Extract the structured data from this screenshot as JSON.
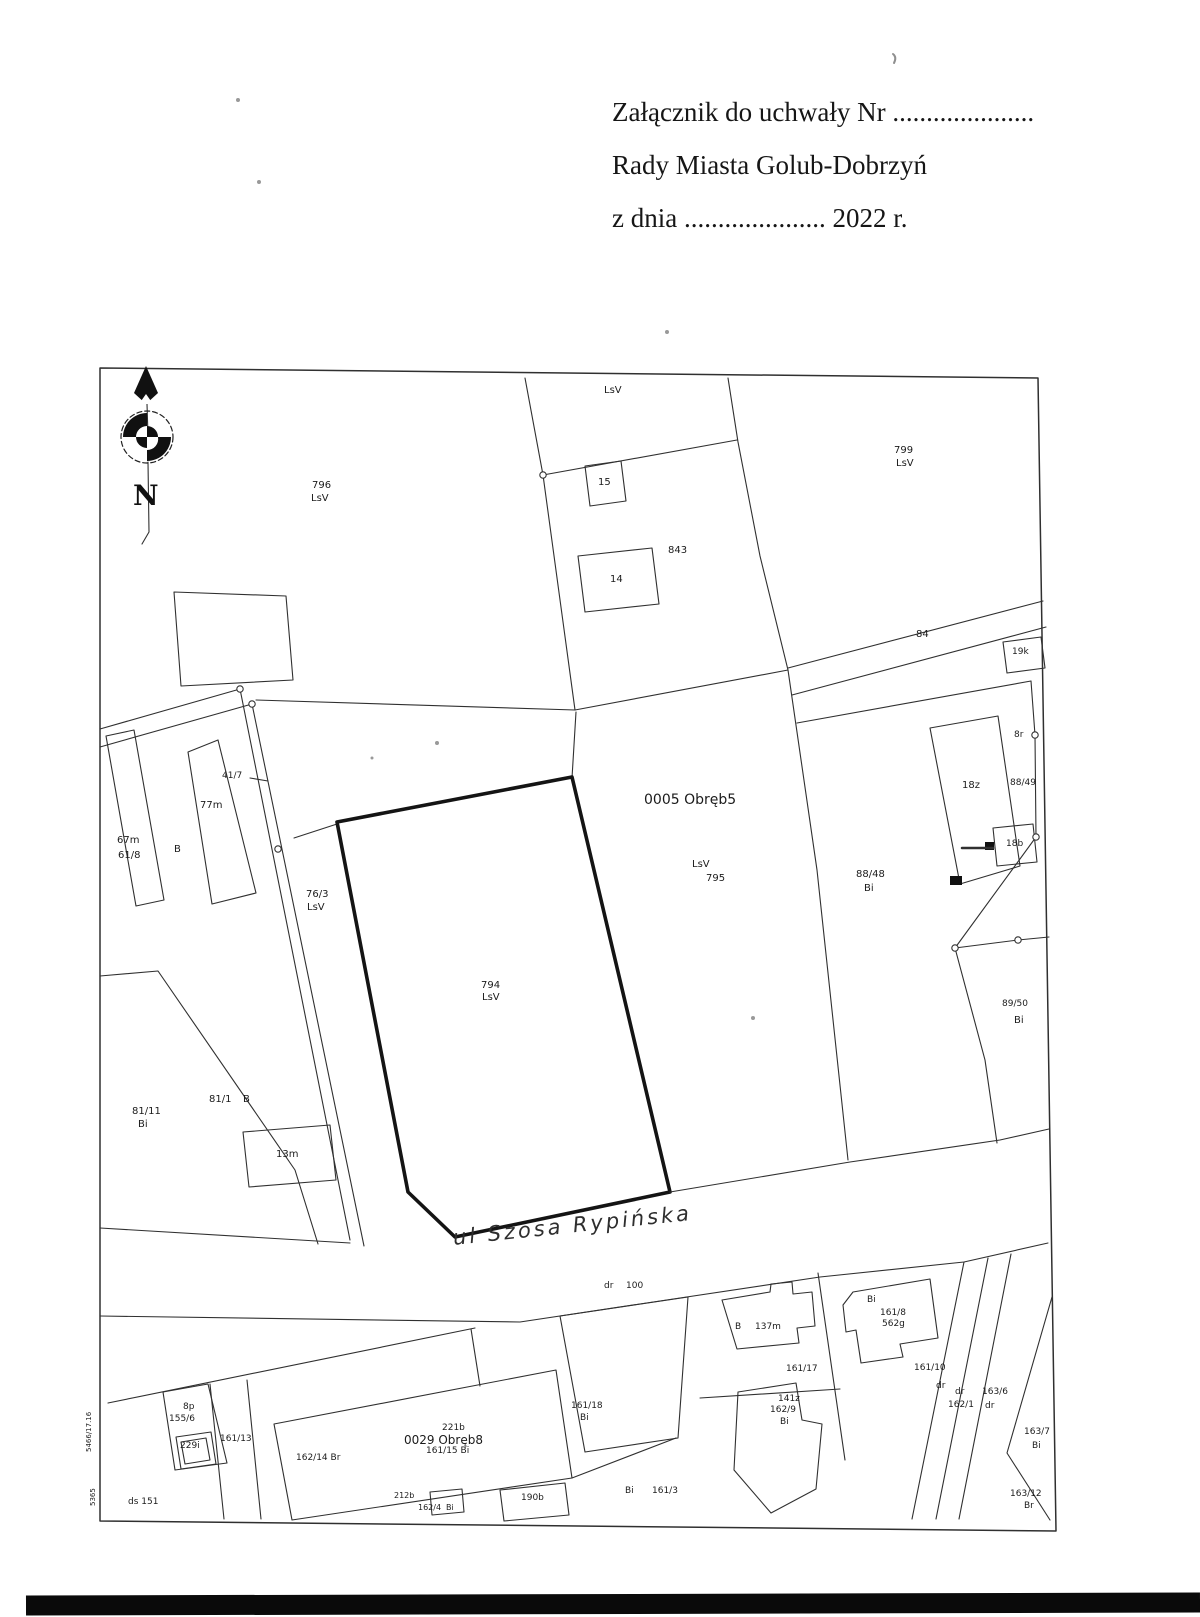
{
  "document": {
    "attachment_line": "Załącznik do uchwały Nr .....................",
    "council_line": "Rady Miasta Golub-Dobrzyń",
    "date_line": "z dnia ..................... 2022 r."
  },
  "map": {
    "compass_n": "N",
    "ink_color": "#303030",
    "bold_parcel_color": "#141414",
    "labels": [
      {
        "text": "796",
        "x": 312,
        "y": 481
      },
      {
        "text": "LsV",
        "x": 311,
        "y": 494
      },
      {
        "text": "LsV",
        "x": 604,
        "y": 386
      },
      {
        "text": "15",
        "x": 598,
        "y": 478
      },
      {
        "text": "14",
        "x": 610,
        "y": 575
      },
      {
        "text": "843",
        "x": 668,
        "y": 546
      },
      {
        "text": "799",
        "x": 894,
        "y": 446
      },
      {
        "text": "LsV",
        "x": 896,
        "y": 459
      },
      {
        "text": "84",
        "x": 916,
        "y": 630
      },
      {
        "text": "19k",
        "x": 1012,
        "y": 648,
        "size": 9
      },
      {
        "text": "8r",
        "x": 1014,
        "y": 731,
        "size": 9
      },
      {
        "text": "88/49",
        "x": 1010,
        "y": 779,
        "size": 9
      },
      {
        "text": "18z",
        "x": 962,
        "y": 781
      },
      {
        "text": "18b",
        "x": 1006,
        "y": 840,
        "size": 9
      },
      {
        "text": "88/48",
        "x": 856,
        "y": 870
      },
      {
        "text": "Bi",
        "x": 864,
        "y": 884
      },
      {
        "text": "0005 Obręb5",
        "x": 644,
        "y": 793,
        "size": 14
      },
      {
        "text": "LsV",
        "x": 692,
        "y": 860
      },
      {
        "text": "795",
        "x": 706,
        "y": 874
      },
      {
        "text": "41/7",
        "x": 222,
        "y": 772,
        "size": 9
      },
      {
        "text": "77m",
        "x": 200,
        "y": 801
      },
      {
        "text": "67m",
        "x": 117,
        "y": 836
      },
      {
        "text": "61/8",
        "x": 118,
        "y": 851
      },
      {
        "text": "B",
        "x": 174,
        "y": 845
      },
      {
        "text": "76/3",
        "x": 306,
        "y": 890
      },
      {
        "text": "LsV",
        "x": 307,
        "y": 903
      },
      {
        "text": "794",
        "x": 481,
        "y": 981
      },
      {
        "text": "LsV",
        "x": 482,
        "y": 993
      },
      {
        "text": "89/50",
        "x": 1002,
        "y": 1000,
        "size": 9
      },
      {
        "text": "Bi",
        "x": 1014,
        "y": 1016
      },
      {
        "text": "81/11",
        "x": 132,
        "y": 1107
      },
      {
        "text": "Bi",
        "x": 138,
        "y": 1120
      },
      {
        "text": "81/1",
        "x": 209,
        "y": 1095
      },
      {
        "text": "B",
        "x": 243,
        "y": 1095
      },
      {
        "text": "13m",
        "x": 276,
        "y": 1150
      },
      {
        "text": "ul Szosa Rypińska",
        "x": 452,
        "y": 1228,
        "size": 21,
        "rot": -6,
        "hand": true
      },
      {
        "text": "dr",
        "x": 604,
        "y": 1282,
        "size": 9
      },
      {
        "text": "100",
        "x": 626,
        "y": 1282,
        "size": 9
      },
      {
        "text": "B",
        "x": 735,
        "y": 1323,
        "size": 9
      },
      {
        "text": "137m",
        "x": 755,
        "y": 1323,
        "size": 9
      },
      {
        "text": "Bi",
        "x": 867,
        "y": 1296,
        "size": 9
      },
      {
        "text": "161/8",
        "x": 880,
        "y": 1309,
        "size": 9
      },
      {
        "text": "562g",
        "x": 882,
        "y": 1320,
        "size": 9
      },
      {
        "text": "161/17",
        "x": 786,
        "y": 1365,
        "size": 9
      },
      {
        "text": "141z",
        "x": 778,
        "y": 1395,
        "size": 9
      },
      {
        "text": "162/9",
        "x": 770,
        "y": 1406,
        "size": 9
      },
      {
        "text": "Bi",
        "x": 780,
        "y": 1418,
        "size": 9
      },
      {
        "text": "161/10",
        "x": 914,
        "y": 1364,
        "size": 9
      },
      {
        "text": "dr",
        "x": 936,
        "y": 1382,
        "size": 9
      },
      {
        "text": "dr",
        "x": 955,
        "y": 1388,
        "size": 9
      },
      {
        "text": "162/1",
        "x": 948,
        "y": 1401,
        "size": 9
      },
      {
        "text": "163/6",
        "x": 982,
        "y": 1388,
        "size": 9
      },
      {
        "text": "dr",
        "x": 985,
        "y": 1402,
        "size": 9
      },
      {
        "text": "163/7",
        "x": 1024,
        "y": 1428,
        "size": 9
      },
      {
        "text": "Bi",
        "x": 1032,
        "y": 1442,
        "size": 9
      },
      {
        "text": "8p",
        "x": 183,
        "y": 1403,
        "size": 9
      },
      {
        "text": "155/6",
        "x": 169,
        "y": 1415,
        "size": 9
      },
      {
        "text": "229i",
        "x": 180,
        "y": 1442,
        "size": 9
      },
      {
        "text": "161/13",
        "x": 220,
        "y": 1435,
        "size": 9
      },
      {
        "text": "162/14 Br",
        "x": 296,
        "y": 1454,
        "size": 9
      },
      {
        "text": "221b",
        "x": 442,
        "y": 1424,
        "size": 9
      },
      {
        "text": "0029 Obręb8",
        "x": 404,
        "y": 1434,
        "size": 12
      },
      {
        "text": "161/15 Bi",
        "x": 426,
        "y": 1447,
        "size": 9
      },
      {
        "text": "161/18",
        "x": 571,
        "y": 1402,
        "size": 9
      },
      {
        "text": "Bi",
        "x": 580,
        "y": 1414,
        "size": 9
      },
      {
        "text": "ds 151",
        "x": 128,
        "y": 1498,
        "size": 9
      },
      {
        "text": "212b",
        "x": 394,
        "y": 1492,
        "size": 8
      },
      {
        "text": "162/4",
        "x": 418,
        "y": 1504,
        "size": 8
      },
      {
        "text": "Bi",
        "x": 446,
        "y": 1504,
        "size": 8
      },
      {
        "text": "190b",
        "x": 521,
        "y": 1494,
        "size": 9
      },
      {
        "text": "Bi",
        "x": 625,
        "y": 1487,
        "size": 9
      },
      {
        "text": "161/3",
        "x": 652,
        "y": 1487,
        "size": 9
      },
      {
        "text": "163/12",
        "x": 1010,
        "y": 1490,
        "size": 9
      },
      {
        "text": "Br",
        "x": 1024,
        "y": 1502,
        "size": 9
      },
      {
        "text": "5466/17.16",
        "x": 86,
        "y": 1452,
        "size": 7,
        "rot": -90
      },
      {
        "text": "5365",
        "x": 90,
        "y": 1506,
        "size": 7,
        "rot": -90
      }
    ]
  }
}
